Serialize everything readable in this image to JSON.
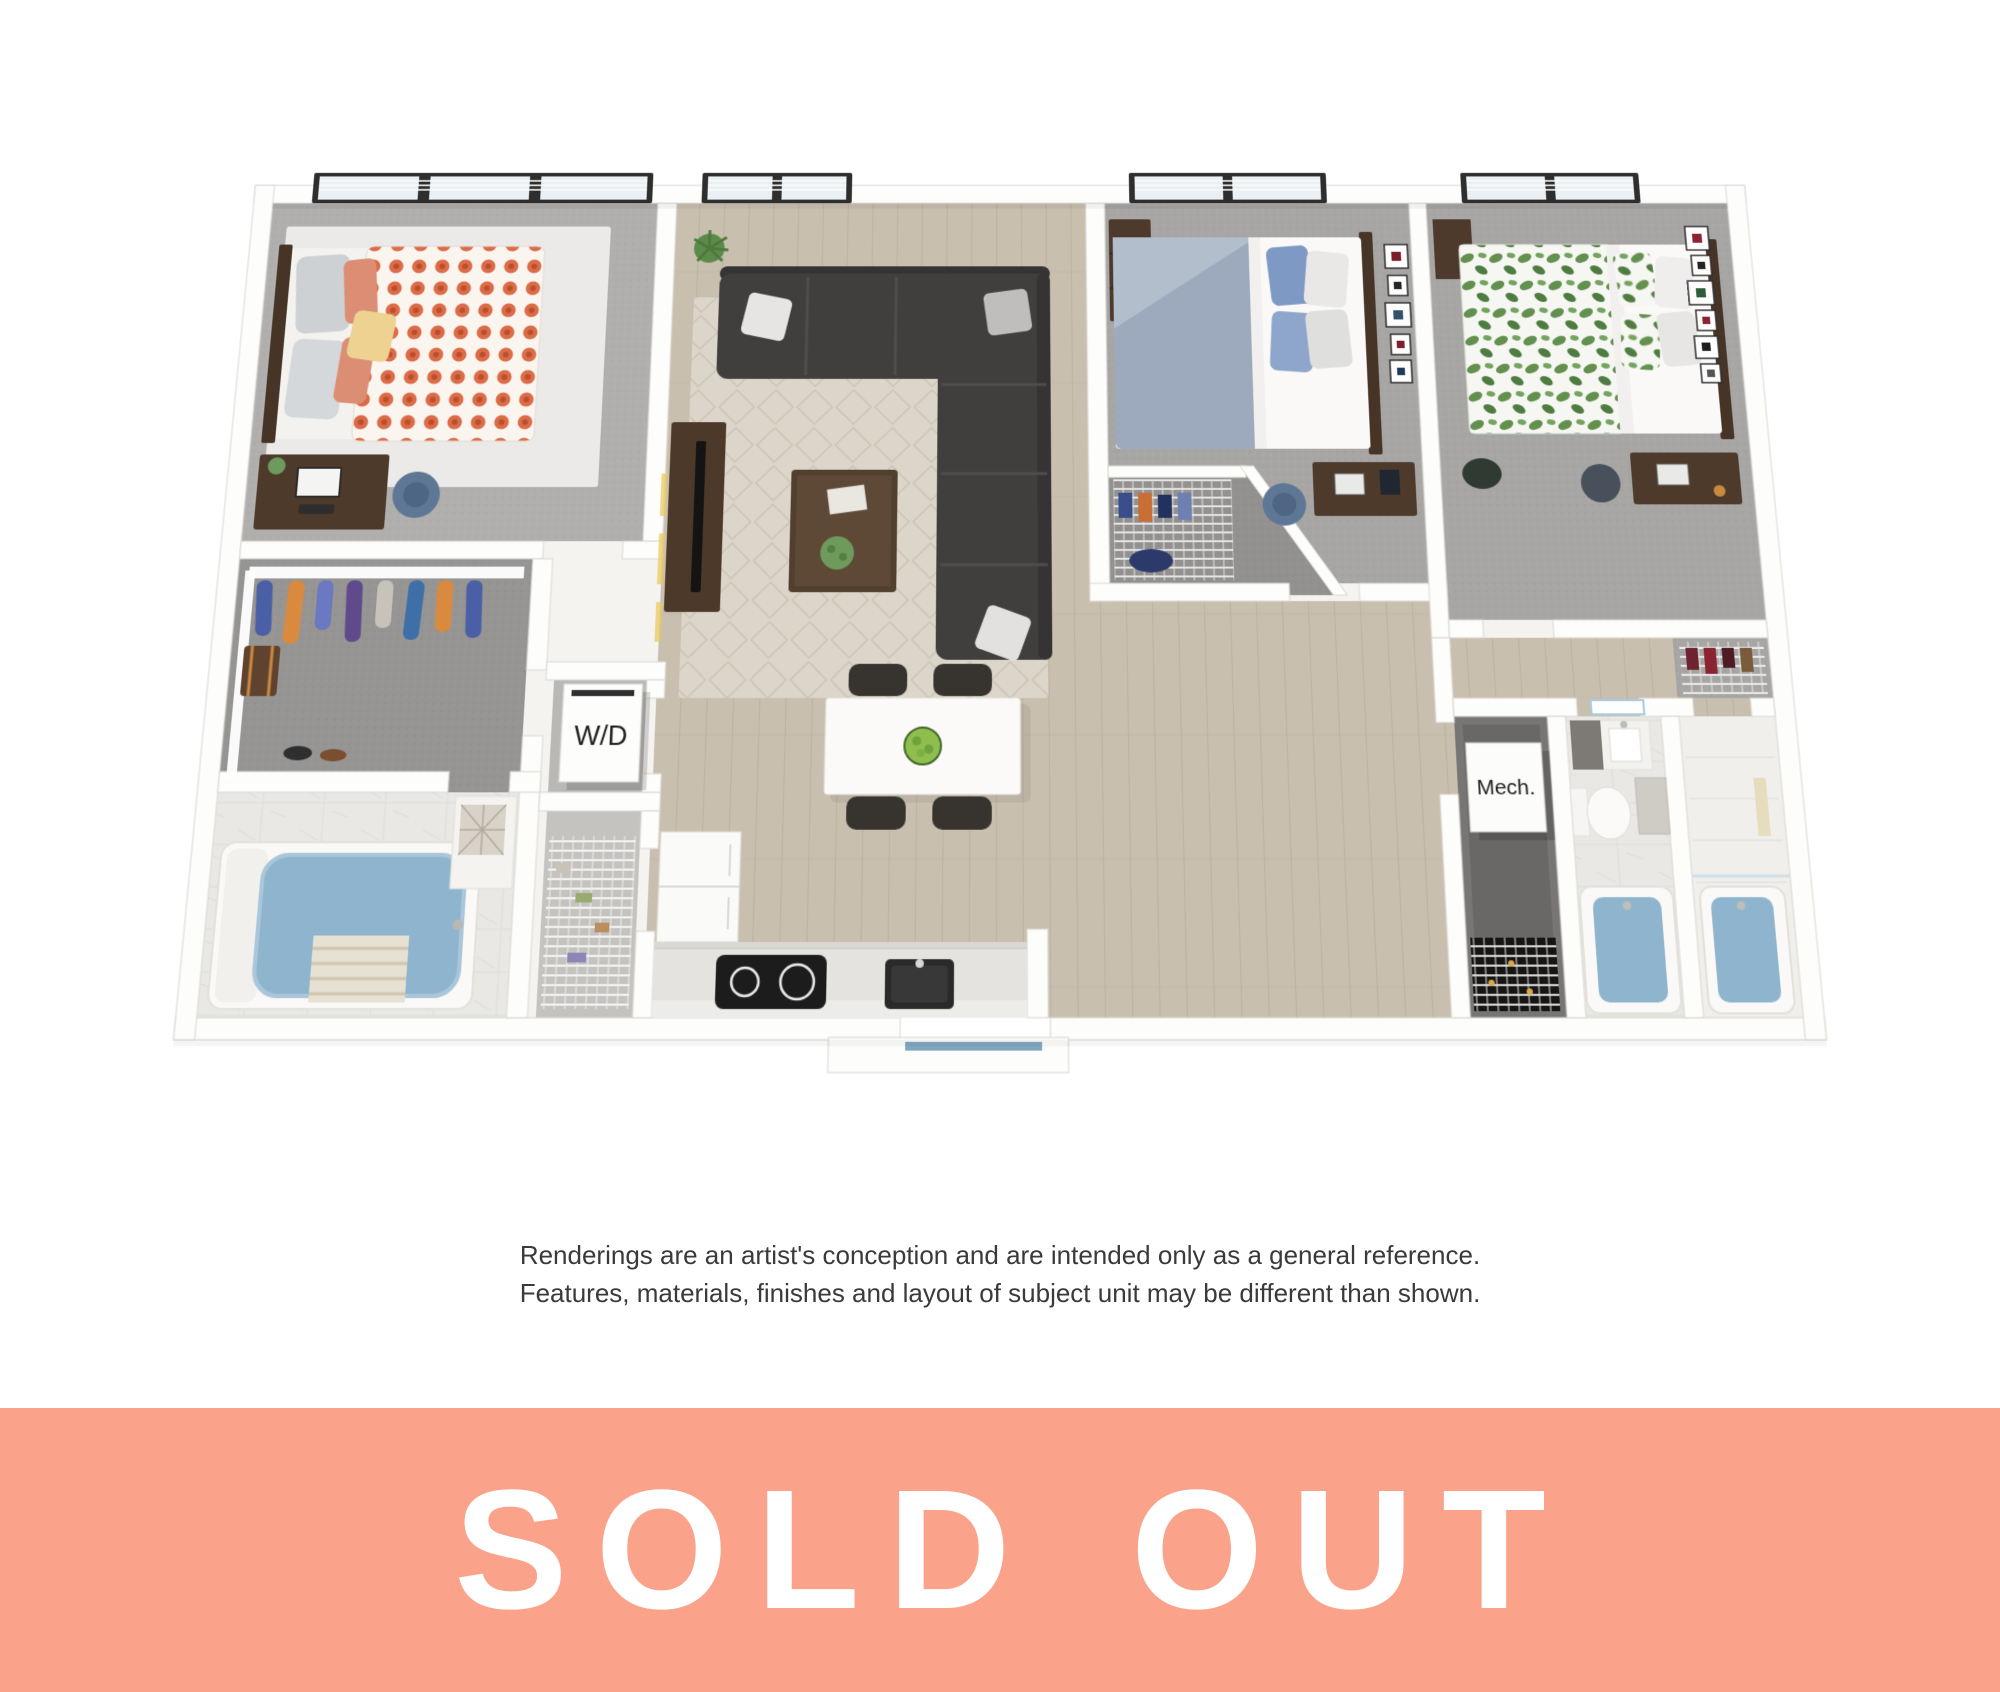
{
  "floor_plan": {
    "description": "3D rendered floor plan of a three-bedroom apartment unit",
    "labels": {
      "washer_dryer": "W/D",
      "mechanical": "Mech."
    },
    "rooms": [
      "bedroom-1",
      "bedroom-2",
      "bedroom-3",
      "living-room",
      "dining-area",
      "kitchen",
      "walk-in-closet",
      "bathroom-1",
      "bathroom-2",
      "bathroom-3",
      "washer-dryer-closet",
      "pantry-closet",
      "mechanical-closet",
      "entry"
    ]
  },
  "disclaimer": {
    "line1": "Renderings are an artist's conception and are intended only as a general reference.",
    "line2": "Features, materials, finishes and layout of subject unit may be different than shown."
  },
  "banner": {
    "label": "SOLD OUT",
    "background_color": "#FAA38A",
    "text_color": "#FFFFFF"
  },
  "palette": {
    "wall": "#FDFDFC",
    "wood_floor": "#C9BFAF",
    "carpet": "#A7A6A4",
    "tub_water": "#8FB5CE",
    "sofa": "#413F3E",
    "duvet_orange_dot": "#DC6C47",
    "duvet_green_leaf": "#63904F",
    "duvet_blue": "#9DAABD"
  }
}
